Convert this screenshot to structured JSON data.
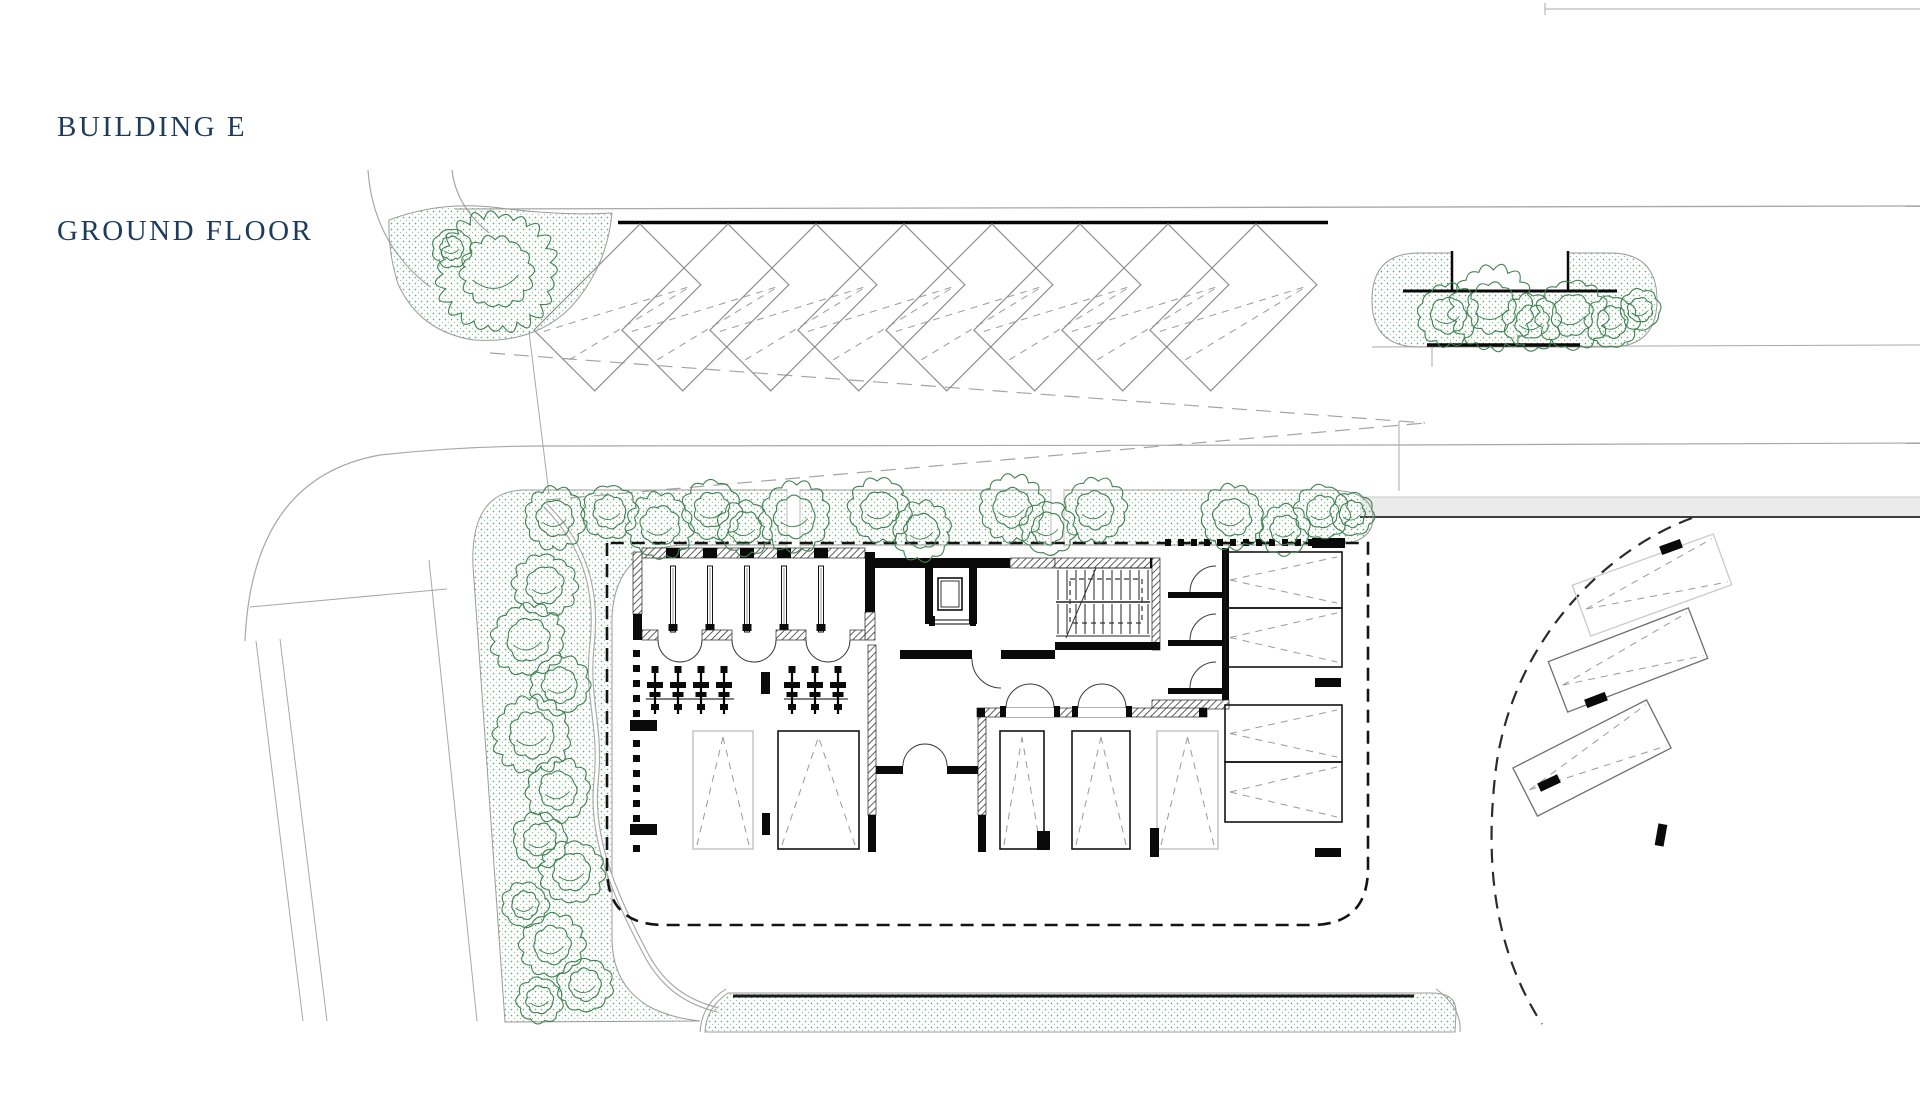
{
  "title": {
    "line1": "BUILDING E",
    "line2": "GROUND FLOOR"
  },
  "colors": {
    "title": "#1d3a5f",
    "tree": "#3f8150",
    "stipple": "#55a46b",
    "wall": "#0a0a0a",
    "road_line": "#a8a8a8",
    "pavement": "#ebebeb",
    "pavement_edge": "#3f3f3f",
    "boundary_dash": "#141414",
    "stall_gray": "#c9c9c9",
    "stall_dark": "#141414",
    "marking_dash": "#9a9a9a",
    "sight_dash": "#a3a3a3"
  },
  "plan": {
    "name": "Building E ground floor site plan",
    "counts": {
      "top_row_angled_stalls": 8,
      "court_parking_stalls": 5,
      "garage_boxes": 4,
      "southeast_angled_stalls": 3,
      "storage_rooms": 6,
      "bike_rack_symbols": 7
    },
    "features": [
      "angled-street-parking-row",
      "landscaped-strips-with-trees",
      "dashed-site-boundary",
      "stair-core-and-elevator",
      "bicycle-parking",
      "court-parking-stalls",
      "southeast-parking-fan"
    ]
  }
}
